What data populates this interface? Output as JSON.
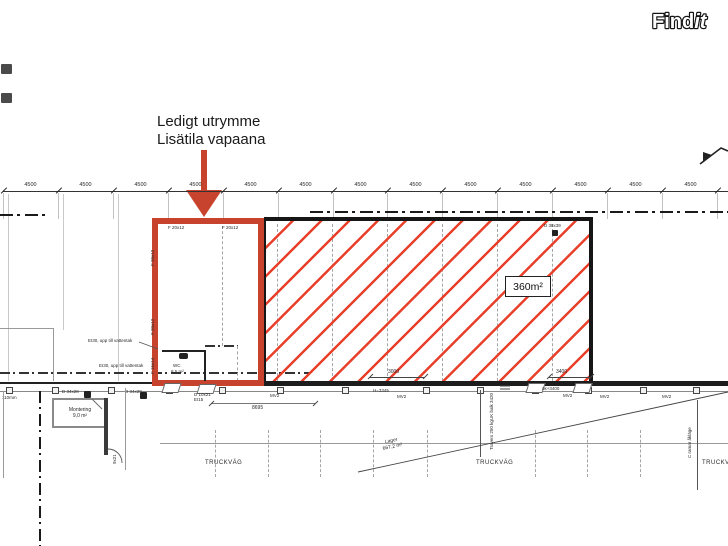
{
  "logo": {
    "part1": "Find",
    "part2": "it"
  },
  "annotation": {
    "line1": "Ledigt utrymme",
    "line2": "Lisätila vapaana"
  },
  "dimension_top": {
    "segment_label": "4500"
  },
  "red_area": {
    "window_top_label": "F 20x12",
    "window_side_label": "F 20x12",
    "window_small_label": "F 15x14",
    "wc_name": "WC",
    "wc_area": "8,5 m²",
    "fire_note": "EI30, upp till vattentak"
  },
  "hatched_area": {
    "area": "360m²",
    "door_label": "D 38x39"
  },
  "bottom": {
    "door_34": "D 34x28",
    "door_10": "D 10x21",
    "door_10_fire": "EI15",
    "door_9": "9x21",
    "mv2": "MV2",
    "h_label": "H=3345",
    "level_label": "ök+3400",
    "dim_3000": "3000",
    "dim_3400": "3400",
    "dim_8695": "8695",
    "thickness": "110mm",
    "montering_name": "Montering",
    "montering_area": "9,0 m²",
    "truck_route": "TRUCKVÄG",
    "lager_name": "Lager",
    "lager_area": "667,2 m²",
    "travers_line1": "Travers 250 kg",
    "travers_line2": "UK balk 3420",
    "crane_note": "C ramar åkläge"
  },
  "colors": {
    "accent_red": "#c8432e",
    "hatch_red": "#e8402b",
    "wall_dark": "#1c1c1c"
  }
}
